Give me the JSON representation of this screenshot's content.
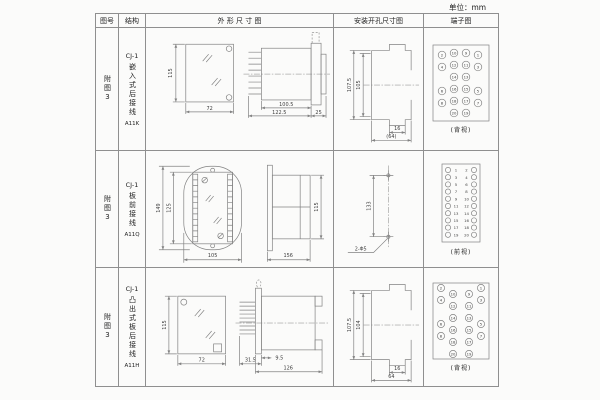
{
  "unit_label": "单位：mm",
  "table": {
    "headers": [
      "图号",
      "结构",
      "外 形 尺 寸 图",
      "安装开孔尺寸图",
      "端子图"
    ],
    "rows": [
      {
        "figure_no": "附图3",
        "structure": {
          "model": "CJ-1",
          "desc": "嵌入式后接线",
          "code": "A11K"
        },
        "outline": {
          "front_height": "115",
          "front_width": "72",
          "body_depth": "100.5",
          "total_depth": "122.5",
          "panel_depth": "25"
        },
        "mounting": {
          "outer_height": "107.5",
          "inner_height": "105",
          "slot_width": "16",
          "total_width": "(64)"
        },
        "terminal": {
          "layout": "grid",
          "caption": "(背视)",
          "rows": [
            [
              "2",
              "10",
              "9",
              "1"
            ],
            [
              "4",
              "12",
              "11",
              "3"
            ],
            [
              "",
              "14",
              "13",
              ""
            ],
            [
              "6",
              "16",
              "15",
              "5"
            ],
            [
              "8",
              "18",
              "17",
              "7"
            ],
            [
              "",
              "20",
              "19",
              ""
            ]
          ]
        }
      },
      {
        "figure_no": "附图3",
        "structure": {
          "model": "CJ-1",
          "desc": "板前接线",
          "code": "A11Q"
        },
        "outline": {
          "front_height": "149",
          "inner_height": "125",
          "front_width": "105",
          "total_depth": "156",
          "body_height": "115"
        },
        "mounting": {
          "hole_pitch": "133",
          "hole_label": "2-Φ5"
        },
        "terminal": {
          "layout": "strip",
          "caption": "(前视)",
          "pairs": [
            [
              "1",
              "2"
            ],
            [
              "3",
              "4"
            ],
            [
              "5",
              "6"
            ],
            [
              "7",
              "8"
            ],
            [
              "9",
              "10"
            ],
            [
              "11",
              "12"
            ],
            [
              "13",
              "14"
            ],
            [
              "15",
              "16"
            ],
            [
              "17",
              "18"
            ],
            [
              "19",
              "20"
            ]
          ]
        }
      },
      {
        "figure_no": "附图3",
        "structure": {
          "model": "CJ-1",
          "desc": "凸出式板后接线",
          "code": "A11H"
        },
        "outline": {
          "front_height": "115",
          "front_width": "72",
          "flange_depth": "31.5",
          "pin_depth": "9.5",
          "total_depth": "126"
        },
        "mounting": {
          "outer_height": "107.5",
          "inner_height": "104",
          "slot_width": "16",
          "total_width": "64"
        },
        "terminal": {
          "layout": "staggered",
          "caption": "(背视)",
          "rows": [
            [
              "2",
              "10",
              "9",
              "1"
            ],
            [
              "4",
              "12",
              "11",
              "3"
            ],
            [
              "",
              "14",
              "13",
              ""
            ],
            [
              "6",
              "16",
              "15",
              "5"
            ],
            [
              "8",
              "18",
              "17",
              "7"
            ],
            [
              "",
              "20",
              "19",
              ""
            ]
          ]
        }
      }
    ]
  }
}
